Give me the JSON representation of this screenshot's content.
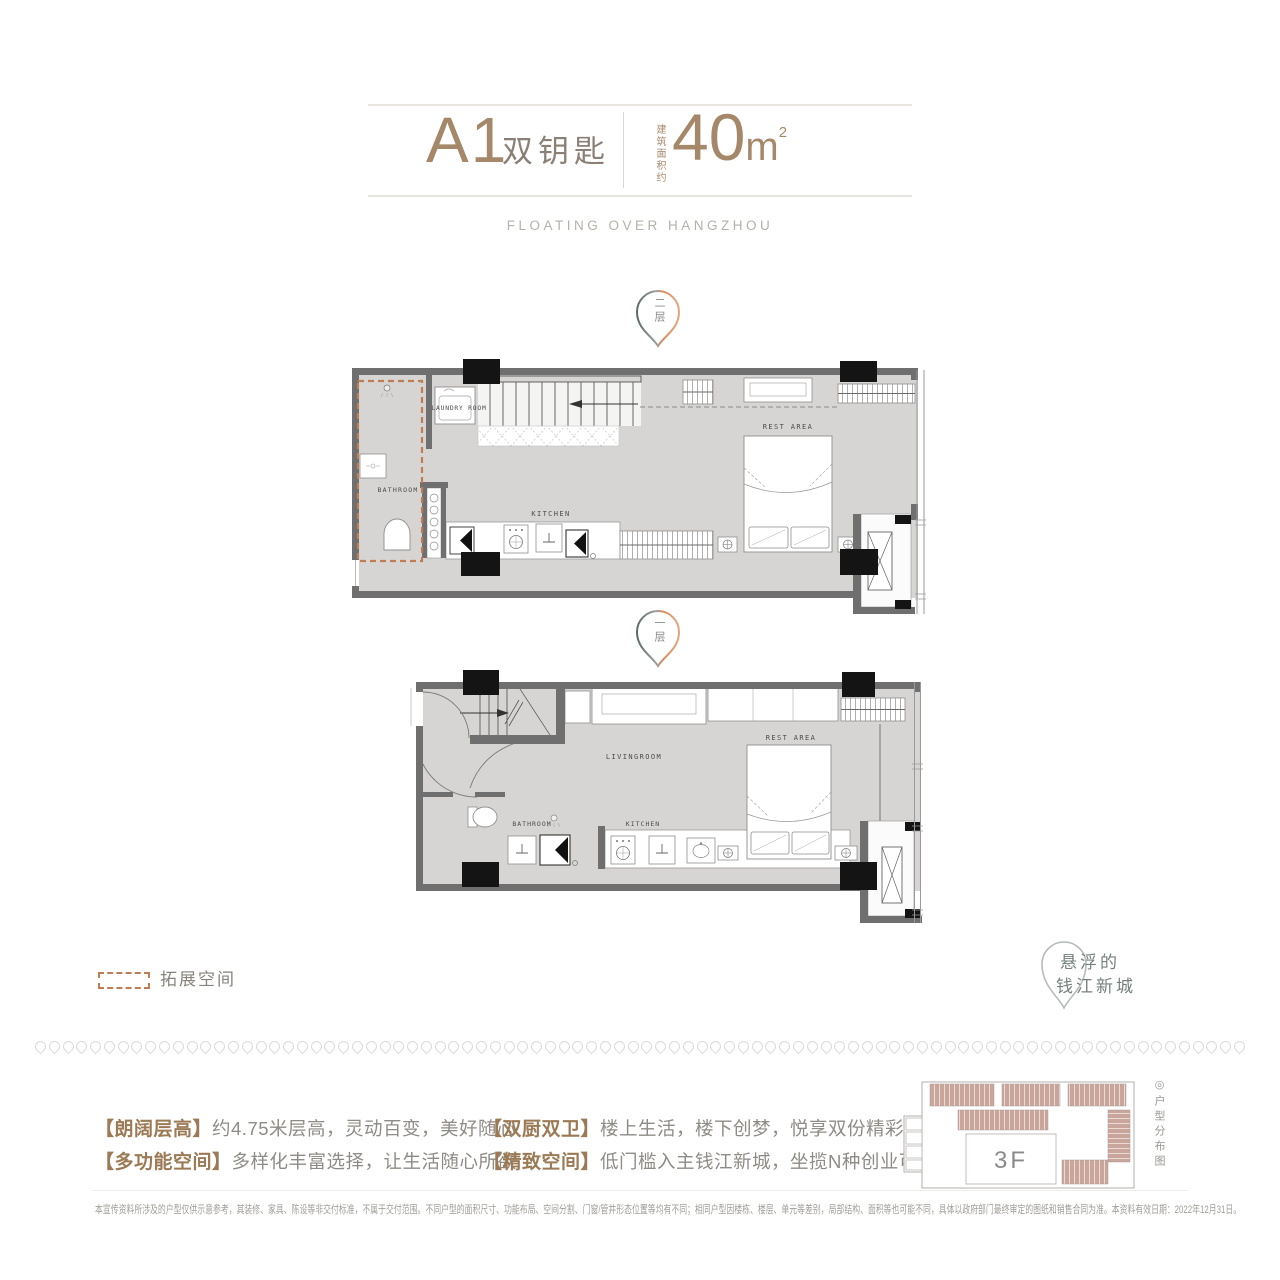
{
  "header": {
    "unit_code": "A1",
    "unit_name": "双钥匙",
    "area_prefix": "建筑面积约",
    "area_value": "40",
    "area_unit": "m",
    "area_sup": "2",
    "tagline": "FLOATING OVER HANGZHOU"
  },
  "markers": {
    "upper": "二层",
    "lower": "一层"
  },
  "plans": {
    "upper": {
      "rooms": {
        "laundry": "LAUNDRY ROOM",
        "bathroom": "BATHROOM",
        "kitchen": "KITCHEN",
        "rest_area": "REST AREA"
      }
    },
    "lower": {
      "rooms": {
        "living": "LIVINGROOM",
        "bathroom": "BATHROOM",
        "kitchen": "KITCHEN",
        "rest_area": "REST AREA"
      }
    }
  },
  "legend": {
    "expansion_label": "拓展空间"
  },
  "brand": {
    "line1": "悬浮的",
    "line2": "钱江新城"
  },
  "features": [
    {
      "tag": "【朗阔层高】",
      "text": "约4.75米层高，灵动百变，美好随心"
    },
    {
      "tag": "【多功能空间】",
      "text": "多样化丰富选择，让生活随心所欲"
    },
    {
      "tag": "【双厨双卫】",
      "text": "楼上生活，楼下创梦，悦享双份精彩"
    },
    {
      "tag": "【精致空间】",
      "text": "低门槛入主钱江新城，坐揽N种创业可能"
    }
  ],
  "keyplan": {
    "floor_label": "3F",
    "caption_icon": "◎",
    "caption": "户型分布图"
  },
  "disclaimer": "本宣传资料所涉及的户型仅供示意参考，其装修、家具、陈设等非交付标准，不属于交付范围。不同户型的面积尺寸、功能布局、空间分割、门窗/管井形态位置等均有不同；相同户型因楼栋、楼层、单元等差别，局部结构、面积等也可能不同，具体以政府部门最终审定的图纸和销售合同为准。本资料有效日期：2022年12月31日。",
  "colors": {
    "accent_brown": "#a5886a",
    "unit_name_gray": "#8a8076",
    "feature_tag": "#9b7a55",
    "feature_text": "#8f8b86",
    "expansion_dash": "#c07d53",
    "wall": "#6f6f6f",
    "floor": "#d6d5d3",
    "column": "#141414",
    "keyplan_unit": "#c9a59c",
    "marker_gradient_left": "#5c6b66",
    "marker_gradient_right": "#d98e62"
  }
}
